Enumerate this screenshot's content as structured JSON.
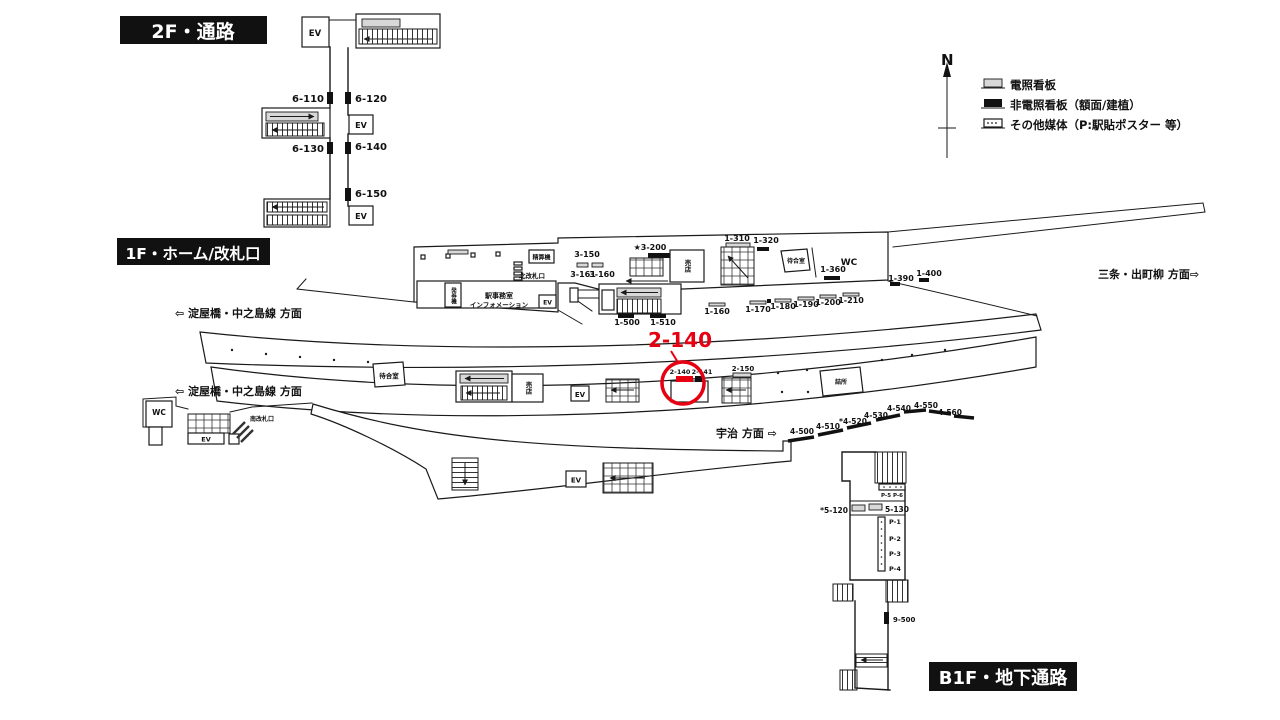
{
  "headers": {
    "f2": "2F・通路",
    "f1": "1F・ホーム/改札口",
    "b1f": "B1F・地下通路"
  },
  "highlight": {
    "label": "2-140",
    "color": "#e60012"
  },
  "compass": {
    "north": "N"
  },
  "legend": {
    "items": [
      {
        "icon": "lit-sign-icon",
        "label": "電照看板"
      },
      {
        "icon": "unlit-sign-icon",
        "label": "非電照看板（額面/建植）"
      },
      {
        "icon": "other-media-icon",
        "label": "その他媒体（P:駅貼ポスター 等）"
      }
    ]
  },
  "directions": {
    "yodoyabashi": "⇦ 淀屋橋・中之島線 方面",
    "sanjo": "三条・出町柳 方面⇨",
    "uji": "宇治 方面 ⇨"
  },
  "rooms": {
    "ev": "EV",
    "wc": "WC",
    "kiosk": "売店",
    "waiting_room": "待合室",
    "north_gate": "北改札口",
    "south_gate": "南改札口",
    "ticket_machines": "発券機",
    "station_office": "駅事務室",
    "information": "インフォメーション",
    "fare_adjustment": "精算機",
    "staff_room": "詰所"
  },
  "signs": {
    "f2": [
      "6-110",
      "6-120",
      "6-130",
      "6-140",
      "6-150"
    ],
    "f1_north": [
      "3-150",
      "3-161",
      "3-160",
      "★3-200",
      "1-310",
      "1-320",
      "1-360",
      "1-390",
      "1-400"
    ],
    "f1_concourse": [
      "1-500",
      "1-510"
    ],
    "f1_platform_edge": [
      "1-160",
      "1-170",
      "1-180",
      "1-190",
      "1-200",
      "1-210"
    ],
    "f1_island": [
      "2-140",
      "2-141",
      "2-150"
    ],
    "f1_south": [
      "4-500",
      "4-510",
      "*4-520",
      "4-530",
      "4-540",
      "4-550",
      "4-560"
    ],
    "b1f": [
      "P-5 P-6",
      "*5-120",
      "5-130",
      "P-1",
      "P-2",
      "P-3",
      "P-4",
      "9-500"
    ]
  }
}
